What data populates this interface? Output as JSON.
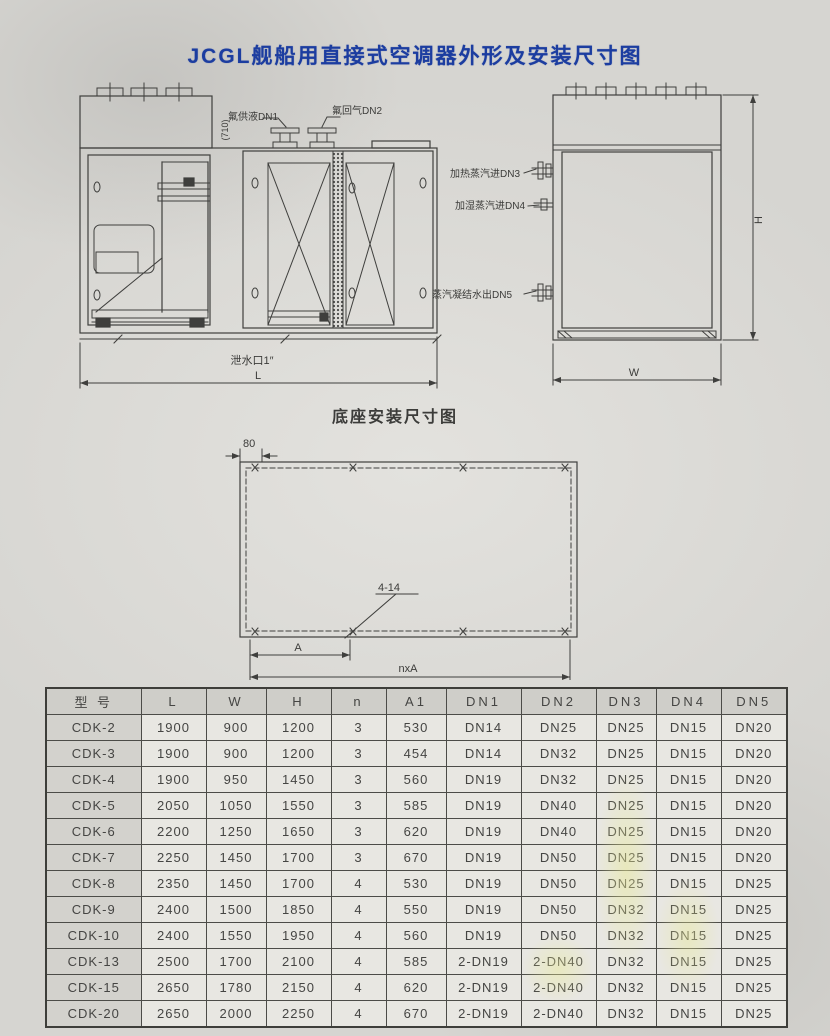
{
  "page": {
    "title": "JCGL舰船用直接式空调器外形及安装尺寸图"
  },
  "front_view": {
    "labels": {
      "dn1": "氟供液DN1",
      "dn2": "氟回气DN2",
      "dim_710": "(710)",
      "drain": "泄水口1″",
      "length": "L"
    }
  },
  "side_view": {
    "labels": {
      "dn3": "加热蒸汽进DN3",
      "dn4": "加湿蒸汽进DN4",
      "dn5": "蒸汽凝结水出DN5",
      "height": "H",
      "width": "W"
    }
  },
  "base_drawing": {
    "title": "底座安装尺寸图",
    "labels": {
      "dim_80": "80",
      "holes": "4-14",
      "dim_a": "A",
      "dim_nxa": "nxA"
    }
  },
  "table": {
    "headers": [
      "型 号",
      "L",
      "W",
      "H",
      "n",
      "A1",
      "DN1",
      "DN2",
      "DN3",
      "DN4",
      "DN5"
    ],
    "rows": [
      [
        "CDK-2",
        "1900",
        "900",
        "1200",
        "3",
        "530",
        "DN14",
        "DN25",
        "DN25",
        "DN15",
        "DN20"
      ],
      [
        "CDK-3",
        "1900",
        "900",
        "1200",
        "3",
        "454",
        "DN14",
        "DN32",
        "DN25",
        "DN15",
        "DN20"
      ],
      [
        "CDK-4",
        "1900",
        "950",
        "1450",
        "3",
        "560",
        "DN19",
        "DN32",
        "DN25",
        "DN15",
        "DN20"
      ],
      [
        "CDK-5",
        "2050",
        "1050",
        "1550",
        "3",
        "585",
        "DN19",
        "DN40",
        "DN25",
        "DN15",
        "DN20"
      ],
      [
        "CDK-6",
        "2200",
        "1250",
        "1650",
        "3",
        "620",
        "DN19",
        "DN40",
        "DN25",
        "DN15",
        "DN20"
      ],
      [
        "CDK-7",
        "2250",
        "1450",
        "1700",
        "3",
        "670",
        "DN19",
        "DN50",
        "DN25",
        "DN15",
        "DN20"
      ],
      [
        "CDK-8",
        "2350",
        "1450",
        "1700",
        "4",
        "530",
        "DN19",
        "DN50",
        "DN25",
        "DN15",
        "DN25"
      ],
      [
        "CDK-9",
        "2400",
        "1500",
        "1850",
        "4",
        "550",
        "DN19",
        "DN50",
        "DN32",
        "DN15",
        "DN25"
      ],
      [
        "CDK-10",
        "2400",
        "1550",
        "1950",
        "4",
        "560",
        "DN19",
        "DN50",
        "DN32",
        "DN15",
        "DN25"
      ],
      [
        "CDK-13",
        "2500",
        "1700",
        "2100",
        "4",
        "585",
        "2-DN19",
        "2-DN40",
        "DN32",
        "DN15",
        "DN25"
      ],
      [
        "CDK-15",
        "2650",
        "1780",
        "2150",
        "4",
        "620",
        "2-DN19",
        "2-DN40",
        "DN32",
        "DN15",
        "DN25"
      ],
      [
        "CDK-20",
        "2650",
        "2000",
        "2250",
        "4",
        "670",
        "2-DN19",
        "2-DN40",
        "DN32",
        "DN15",
        "DN25"
      ]
    ]
  },
  "colors": {
    "title_blue": "#1c3da0",
    "line": "#3f3f3d",
    "paper": "#d6d5d1",
    "highlight_yellow": "#e9e996"
  }
}
